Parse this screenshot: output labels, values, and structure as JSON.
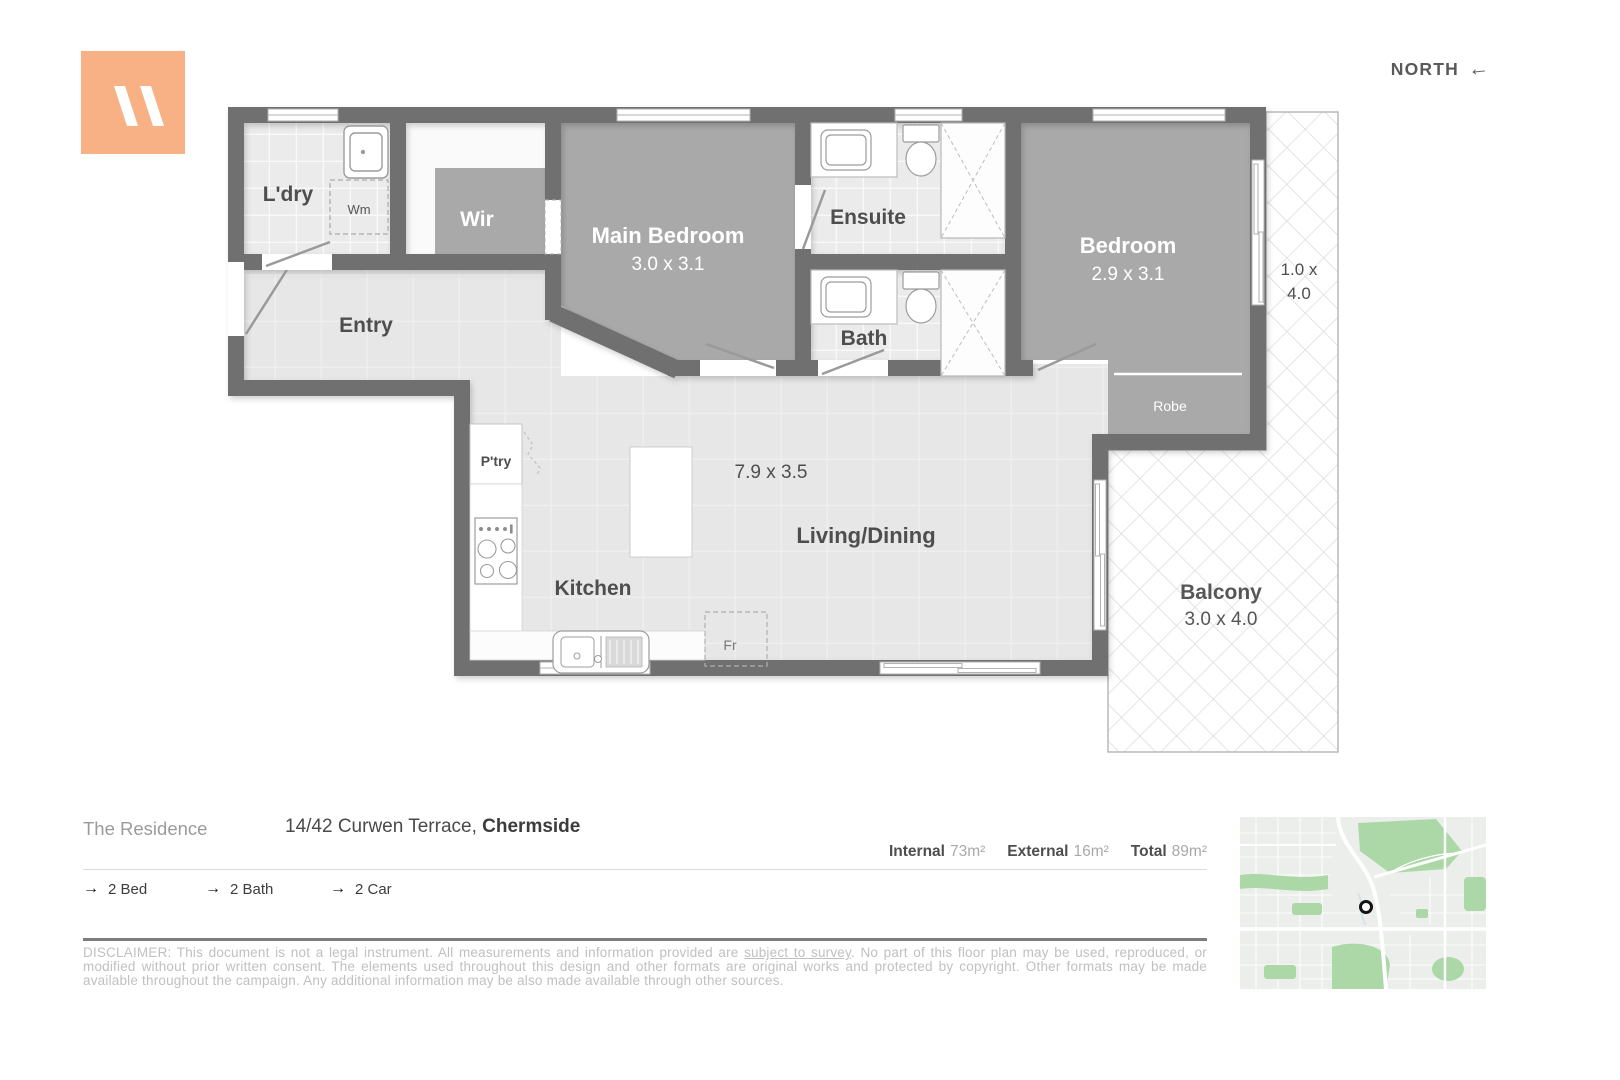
{
  "north": {
    "label": "NORTH",
    "arrow": "←"
  },
  "logo": {
    "color": "#f8b184"
  },
  "plan": {
    "rooms": {
      "ldry": {
        "label": "L'dry"
      },
      "wm": {
        "label": "Wm"
      },
      "wir": {
        "label": "Wir"
      },
      "main_bedroom": {
        "label": "Main Bedroom",
        "dims": "3.0 x 3.1"
      },
      "ensuite": {
        "label": "Ensuite"
      },
      "bath": {
        "label": "Bath"
      },
      "bedroom": {
        "label": "Bedroom",
        "dims": "2.9 x 3.1"
      },
      "robe": {
        "label": "Robe"
      },
      "entry": {
        "label": "Entry"
      },
      "pantry": {
        "label": "P'try"
      },
      "kitchen": {
        "label": "Kitchen"
      },
      "fridge": {
        "label": "Fr"
      },
      "living": {
        "label": "Living/Dining",
        "dims": "7.9 x 3.5"
      },
      "balcony": {
        "label": "Balcony",
        "dims": "3.0 x 4.0"
      },
      "side_balcony": {
        "dims_line1": "1.0 x",
        "dims_line2": "4.0"
      }
    }
  },
  "footer": {
    "brand": "The Residence",
    "address_street": "14/42 Curwen Terrace, ",
    "address_suburb": "Chermside",
    "areas": [
      {
        "label": "Internal",
        "value": "73m²"
      },
      {
        "label": "External",
        "value": "16m²"
      },
      {
        "label": "Total",
        "value": "89m²"
      }
    ],
    "feature_arrow": "→",
    "features": [
      {
        "label": "2 Bed"
      },
      {
        "label": "2 Bath"
      },
      {
        "label": "2 Car"
      }
    ],
    "disclaimer_pre": "DISCLAIMER: This document is not a legal instrument. All measurements and information provided are ",
    "disclaimer_link": "subject to survey",
    "disclaimer_post": ". No part of this floor plan may be used, reproduced, or modified without prior written consent. The elements used throughout this design and other formats are original works and protected by copyright. Other formats may be made available throughout the campaign. Any additional information may be also made available through other sources."
  }
}
